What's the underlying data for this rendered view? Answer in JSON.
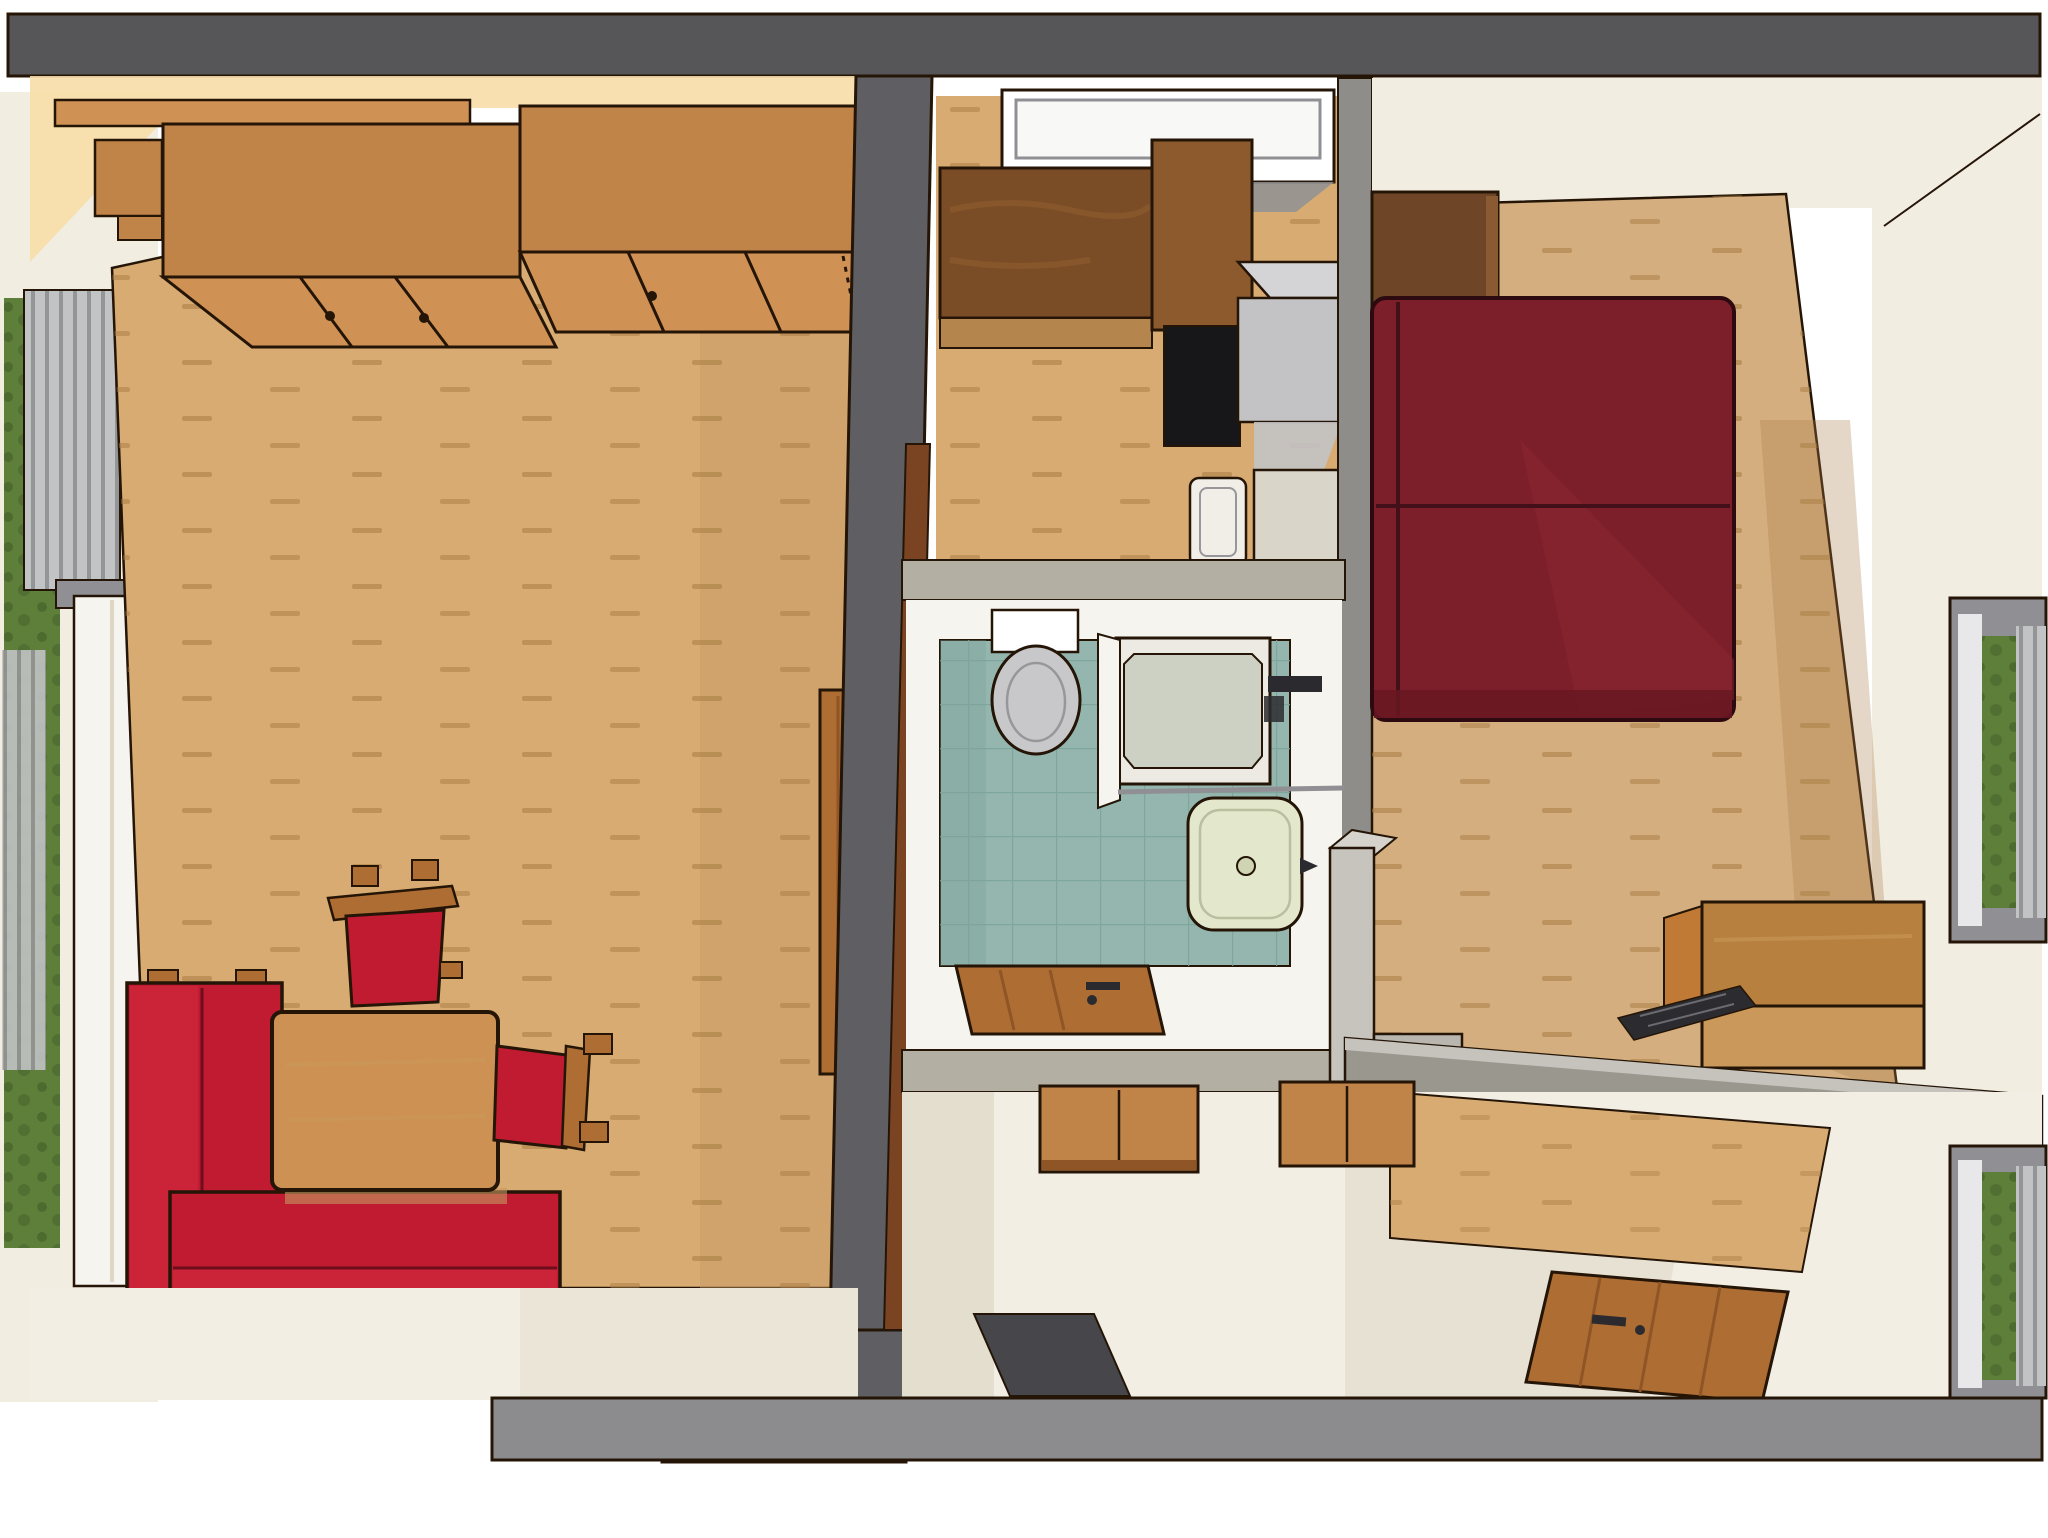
{
  "scene": {
    "type": "3d-floorplan-render",
    "view": "birds-eye axonometric, roof removed",
    "description": "Top-down 3D architectural rendering of a small two-room apartment: living room with wardrobe and red seating on the left, kitchen / bathroom / entry hall in the middle strip, bedroom with bed, desk and entry nook on the right.",
    "rooms": [
      {
        "name": "living-room",
        "position": "left",
        "floor": "light wood planks",
        "objects": [
          "wall-wardrobe with top shelf and sliding doors",
          "left window with vertical blinds and garden view",
          "open casement panels",
          "L-shaped red sofa with wood armrests",
          "wooden table",
          "red chair with wood back (top)",
          "red chair with wood back (right)",
          "open wooden room door against central wall"
        ]
      },
      {
        "name": "kitchen",
        "position": "top-center",
        "floor": "light wood planks",
        "objects": [
          "window over counter",
          "dark walnut L-shaped countertop",
          "black cooktop",
          "gray extractor appliance",
          "white sink basin",
          "white base cabinet"
        ]
      },
      {
        "name": "bathroom",
        "position": "center",
        "floor": "teal ceramic tiles",
        "objects": [
          "toilet with cistern",
          "corner shower with glass door and dark faucet set",
          "pale-green washbasin with drain",
          "glass shelf",
          "open wooden bathroom door"
        ]
      },
      {
        "name": "hallway",
        "position": "bottom-center",
        "floor": "off-white screed",
        "objects": [
          "wooden wall cabinet with two doors",
          "dark gray doormat"
        ]
      },
      {
        "name": "bedroom",
        "position": "right",
        "floor": "light wood planks",
        "objects": [
          "double bed with dark red cover and seams",
          "dark walnut headboard shelf",
          "gray partition half-wall",
          "wooden desk",
          "dark keyboard on floor",
          "right window with blinds and garden view"
        ]
      },
      {
        "name": "entry-room",
        "position": "bottom-right",
        "floor": "off-white screed with wood patch",
        "objects": [
          "wooden wall cabinet",
          "open wooden entry door with handle",
          "lower right window with garden view"
        ]
      }
    ],
    "palette": {
      "canvas": "#ffffff",
      "outline": "#241507",
      "wall_top": "#565659",
      "wall_center": "#5f5f63",
      "wall_light": "#b3afa3",
      "wall_divider": "#9a978f",
      "wall_bottom": "#8c8c8e",
      "wall_inner_white": "#f2ede1",
      "wall_shadow": "#ded7c6",
      "glow_warm": "#f7dda8",
      "floor_wood": "#d8ab72",
      "floor_wood_dark": "#c59a63",
      "floor_dash": "#a87c44",
      "floor_bedroom": "#d4ae7e",
      "floor_white": "#f2eee3",
      "cabinet_wood": "#c08348",
      "cabinet_wood_light": "#cf9254",
      "counter_dark": "#7b4d27",
      "counter_mid": "#8d5a2e",
      "counter_light": "#b5854e",
      "headboard_wood": "#6e4527",
      "door_wood": "#ad6d33",
      "door_wood_dark": "#8f5526",
      "door_frame": "#7a4423",
      "red_sofa": "#c01b30",
      "red_sofa_light": "#cb2438",
      "red_seam": "#6e0d1b",
      "red_bed": "#7d1f2a",
      "red_bed_dark": "#671722",
      "red_bed_seam": "#43101a",
      "red_bed_sheen": "#8b2732",
      "table_wood": "#cd9253",
      "desk_wood": "#b8803e",
      "desk_wood_light": "#c9985a",
      "appliance_gray": "#c3c3c5",
      "appliance_gray_dark": "#97979b",
      "appliance_gray_top": "#d4d4d6",
      "cooktop_black": "#17171a",
      "sink_white": "#f0eee6",
      "cabinet_white": "#d9d5c9",
      "tile_teal": "#94b6ae",
      "tile_line": "#7ba49a",
      "toilet_gray": "#c8c8ca",
      "fixture_white": "#f6f4ee",
      "basin_green": "#e3e7cb",
      "hardware_dark": "#2b2b2f",
      "window_frame": "#909094",
      "window_slats": "#c2c3c5",
      "slat_line": "#8e9093",
      "foliage": "#5e7f39",
      "foliage_dark": "#46622b",
      "mat_dark": "#47474b",
      "keyboard_dark": "#2c2c30",
      "partition_gray": "#c7c4be"
    }
  }
}
